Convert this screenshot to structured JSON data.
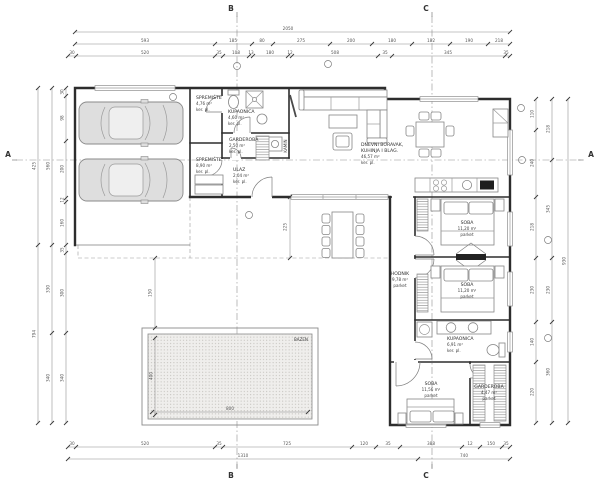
{
  "plan": {
    "rooms": {
      "spremiste1": {
        "name": "SPREMIŠTE",
        "area": "4,76 m²",
        "floor": "ker. pl."
      },
      "kupaonica1": {
        "name": "KUPAONICA",
        "area": "4,60 m²",
        "floor": "ker. pl."
      },
      "garderoba1": {
        "name": "GARDEROBA",
        "area": "2,50 m²",
        "floor": "ker. pl."
      },
      "spremiste2": {
        "name": "SPREMIŠTE",
        "area": "8,90 m²",
        "floor": "ker. pl."
      },
      "ulaz": {
        "name": "ULAZ",
        "area": "2,04 m²",
        "floor": "ker. pl."
      },
      "dnevni": {
        "line1": "DNEVNI BORAVAK,",
        "line2": "KUHINJA I BLAG.",
        "area": "46,57 m²",
        "floor": "ker. pl."
      },
      "hodnik": {
        "name": "HODNIK",
        "area": "9,78 m²",
        "floor": "parket"
      },
      "soba1": {
        "name": "SOBA",
        "area": "11,20 m²",
        "floor": "parket"
      },
      "soba2": {
        "name": "SOBA",
        "area": "11,20 m²",
        "floor": "parket"
      },
      "kupaonica2": {
        "name": "KUPAONICA",
        "area": "6,91 m²",
        "floor": "ker. pl."
      },
      "soba3": {
        "name": "SOBA",
        "area": "11,56 m²",
        "floor": "parket"
      },
      "garderoba2": {
        "name": "GARDEROBA",
        "area": "4,47 m²",
        "floor": "parket"
      }
    },
    "features": {
      "kamin": "KAMIN",
      "bazen": "BAZEN"
    },
    "sections": {
      "a": "A",
      "b": "B",
      "c": "C"
    },
    "dims": {
      "top1": [
        "2050"
      ],
      "top2": [
        "593",
        "185",
        "80",
        "275",
        "200",
        "180",
        "182",
        "190",
        "218"
      ],
      "top3": [
        "30",
        "520",
        "35",
        "108",
        "13",
        "180",
        "12",
        "508",
        "35",
        "345",
        "35"
      ],
      "bottom1": [
        "30",
        "520",
        "35",
        "725",
        "120",
        "35",
        "388",
        "12",
        "150",
        "35"
      ],
      "bottom2": [
        "1310",
        "740"
      ],
      "left_inner": [
        "30",
        "98",
        "200",
        "12",
        "160",
        "35",
        "300",
        "340"
      ],
      "left_mid": [
        "560",
        "330",
        "340"
      ],
      "left_outer": [
        "425",
        "794"
      ],
      "right_inner": [
        "110",
        "240",
        "218",
        "230",
        "140",
        "220"
      ],
      "right_mid": [
        "218",
        "345",
        "230",
        "360"
      ],
      "right_outer": [
        "930"
      ],
      "pool_w": "800",
      "pool_h": "400",
      "pool_gap": "150",
      "terrace_gap": "225"
    }
  }
}
